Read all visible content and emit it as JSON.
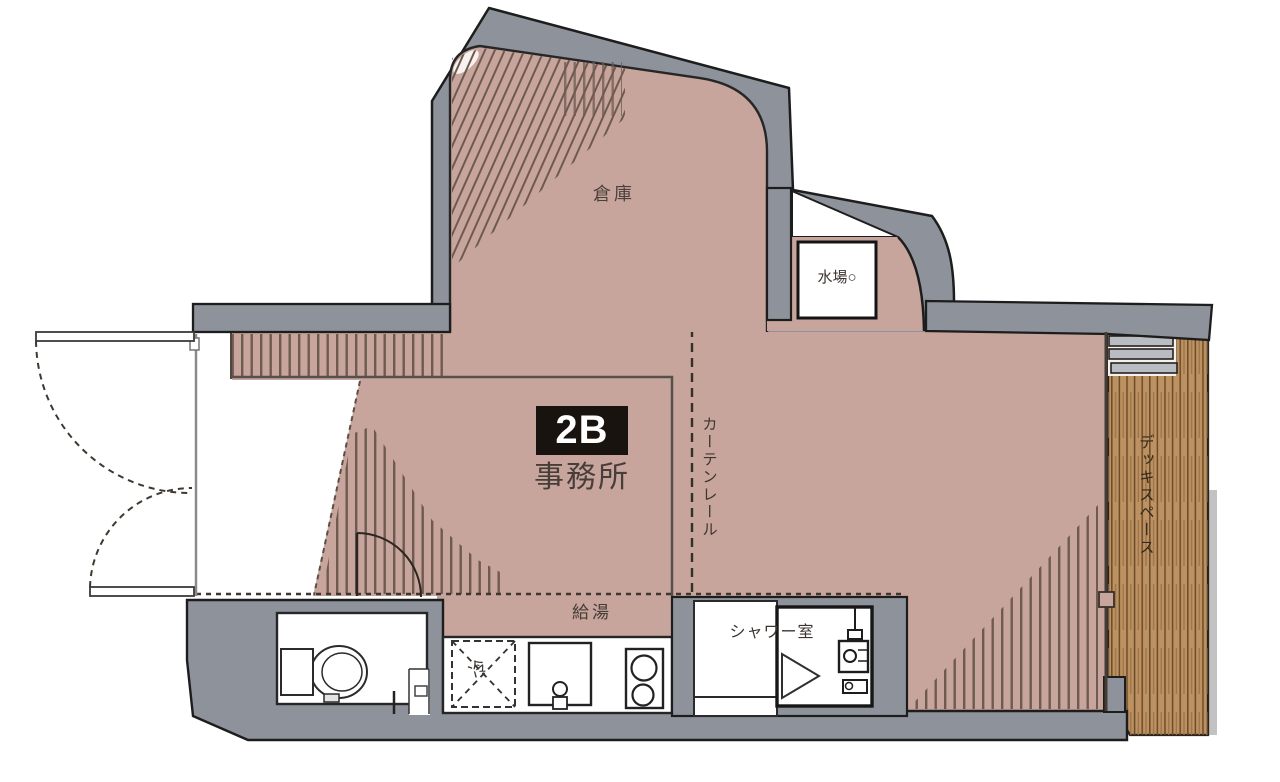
{
  "unit": {
    "number": "2B",
    "use": "事務所"
  },
  "labels": {
    "storage": "倉庫",
    "water_place": "水場○",
    "curtain_rail": "カーテンレール",
    "hot_water": "給湯",
    "shower_room": "シャワー室",
    "fridge": "冷",
    "deck_space": "デッキスペース"
  },
  "colors": {
    "floor": "#c7a59c",
    "wall": "#8e929b",
    "deck": "#bd9161",
    "deck_plank": "#6a4c28",
    "outline": "#1d1d1d",
    "unit_box": "#191310",
    "hatch": "#6e5a50",
    "text": "#453c38"
  }
}
